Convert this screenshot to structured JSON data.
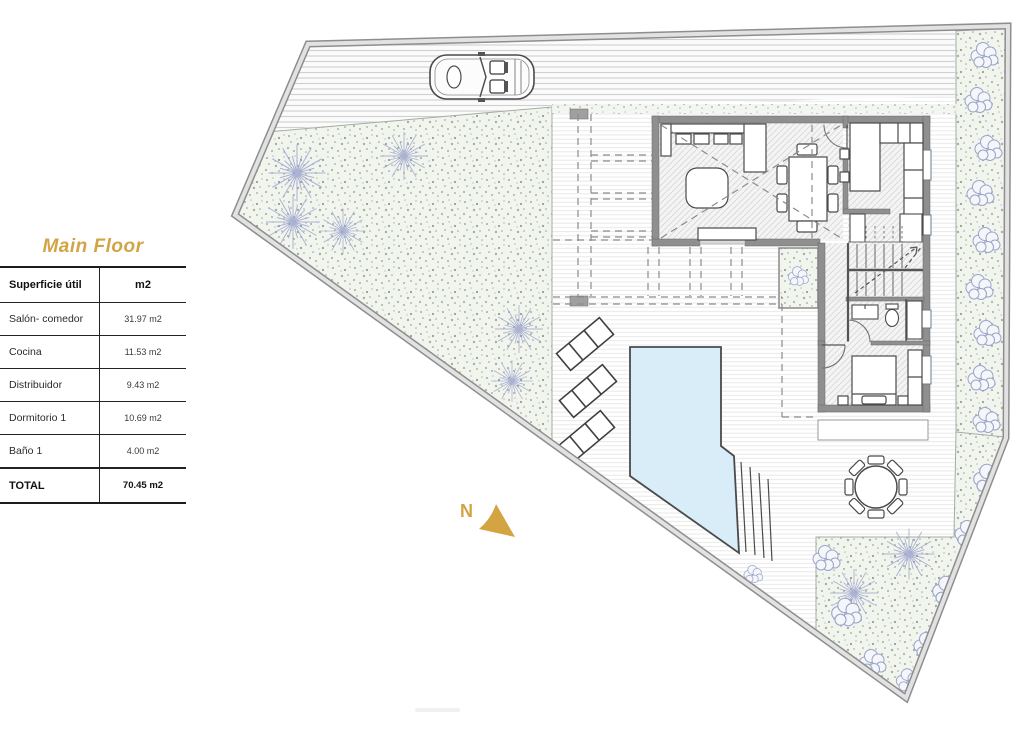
{
  "panel": {
    "title": "Main Floor",
    "table": {
      "col1_header": "Superficie útil",
      "col2_header": "m2",
      "rows": [
        {
          "label": "Salón- comedor",
          "value": "31.97 m2"
        },
        {
          "label": "Cocina",
          "value": "11.53 m2"
        },
        {
          "label": "Distribuidor",
          "value": "9.43 m2"
        },
        {
          "label": "Dormitorio 1",
          "value": "10.69 m2"
        },
        {
          "label": "Baño 1",
          "value": "4.00 m2"
        }
      ],
      "total": {
        "label": "TOTAL",
        "value": "70.45 m2"
      }
    }
  },
  "plan": {
    "north_label": "N",
    "colors": {
      "accent": "#d4a342",
      "pool": "#d9edf8",
      "wall": "#8f8f8f",
      "garden_base": "#f2f5ee",
      "tree": "#9aa2cc",
      "boundary": "#8e8e8e"
    }
  }
}
